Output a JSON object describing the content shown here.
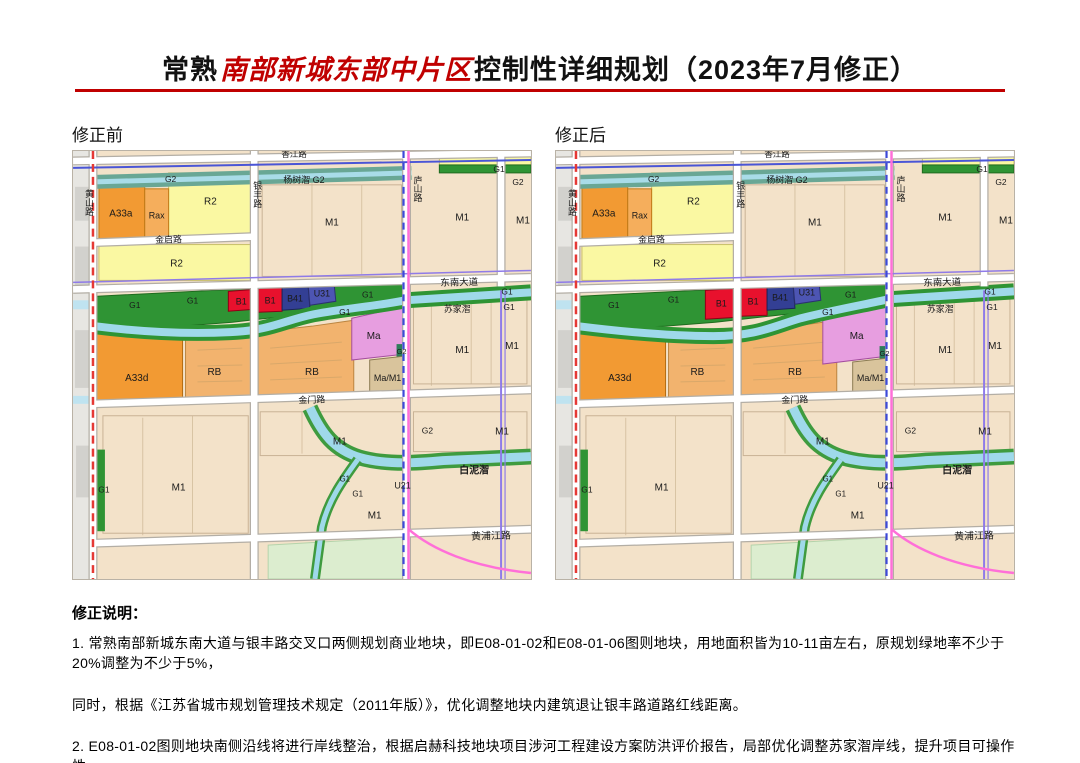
{
  "title": {
    "part1": "常熟",
    "part2": "南部新城东部中片区",
    "part3": "控制性详细规划（2023年7月修正）"
  },
  "captions": {
    "before": "修正前",
    "after": "修正后"
  },
  "map_labels": {
    "G1": "G1",
    "G2": "G2",
    "B1": "B1",
    "B41": "B41",
    "U31": "U31",
    "U21": "U21",
    "Ma": "Ma",
    "MaM1": "Ma/M1",
    "M1": "M1",
    "R2": "R2",
    "RB": "RB",
    "A33a": "A33a",
    "A33d": "A33d",
    "Rax": "Rax"
  },
  "roads": {
    "huangshan": "黄山路",
    "yinfeng": "银丰路",
    "lushan": "庐山路",
    "jinqi": "金启路",
    "dongnan": "东南大道",
    "jinmen": "金门路",
    "huangpujiang": "黄浦江路",
    "xiangjiang": "香江路"
  },
  "rivers": {
    "yangshuzhi_g2": "杨树潪 G2",
    "sujiazhi": "苏家潪",
    "bainizhi": "白泥潪"
  },
  "notes": {
    "heading": "修正说明：",
    "line1": "1. 常熟南部新城东南大道与银丰路交叉口两侧规划商业地块，即E08-01-02和E08-01-06图则地块，用地面积皆为10-11亩左右，原规划绿地率不少于20%调整为不少于5%，",
    "line2": "同时，根据《江苏省城市规划管理技术规定（2011年版）》，优化调整地块内建筑退让银丰路道路红线距离。",
    "line3": "2. E08-01-02图则地块南侧沿线将进行岸线整治，根据启赫科技地块项目涉河工程建设方案防洪评价报告，局部优化调整苏家潪岸线，提升项目可操作性。"
  },
  "colors": {
    "title_red": "#c00000",
    "rule_red": "#c00000",
    "b1_red": "#e8112d",
    "b41_navy": "#333f94",
    "u31_blue": "#4d55b3",
    "g1_green": "#2f9434",
    "g2_teal": "#69a795",
    "ma_pink": "#e79ee0",
    "rb_orange": "#f2b36e",
    "a33_orange": "#f29a33",
    "rax_orange": "#f5ae5c",
    "r2_yellow": "#faf8a2",
    "m1_tan": "#f3e2c9",
    "ma_m1_tan": "#d9c49c",
    "river_blue": "#9fd9ea",
    "park_green": "#dcedcf",
    "huangshan_red_dash": "#e53935",
    "lushan_pink": "#ff6fd8",
    "boundary_blue_dash": "#3c49d8",
    "boundary_purple": "#8f7be8"
  }
}
